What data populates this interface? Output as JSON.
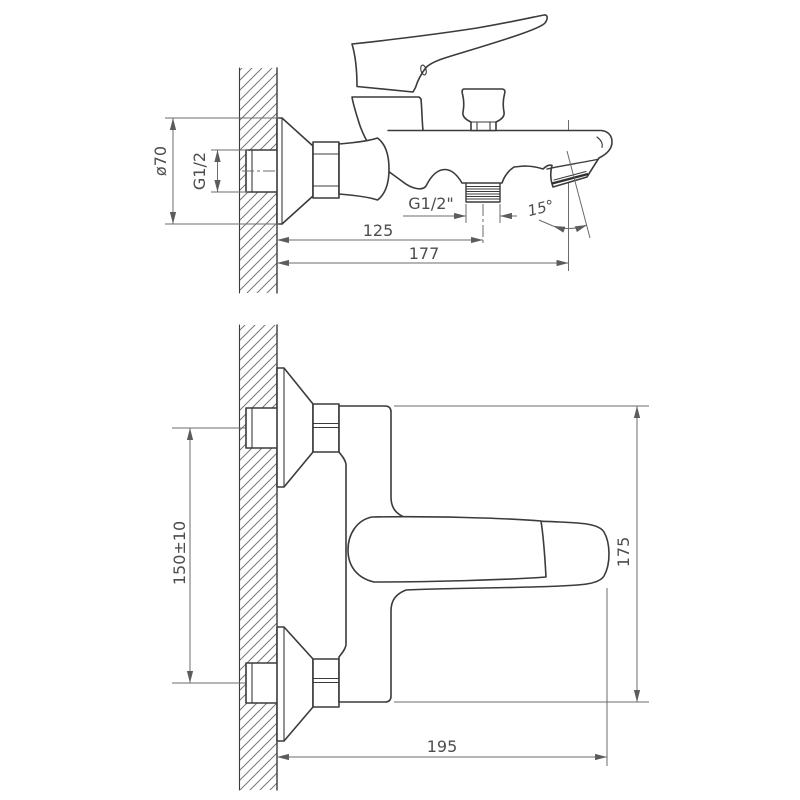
{
  "colors": {
    "background": "#ffffff",
    "outline": "#3b3b3b",
    "dimension_line": "#6b6b6b",
    "dimension_text": "#4d4d4d"
  },
  "drawing": {
    "views": {
      "side": {
        "dims": {
          "flange_dia": "ø70",
          "wall_thread": "G1/2",
          "outlet_thread": "G1/2\"",
          "wall_to_outlet": "125",
          "wall_to_spout_tip": "177",
          "spout_angle": "15°"
        }
      },
      "front": {
        "dims": {
          "inlet_spacing": "150±10",
          "overall_height": "175",
          "projection": "195"
        }
      }
    }
  }
}
